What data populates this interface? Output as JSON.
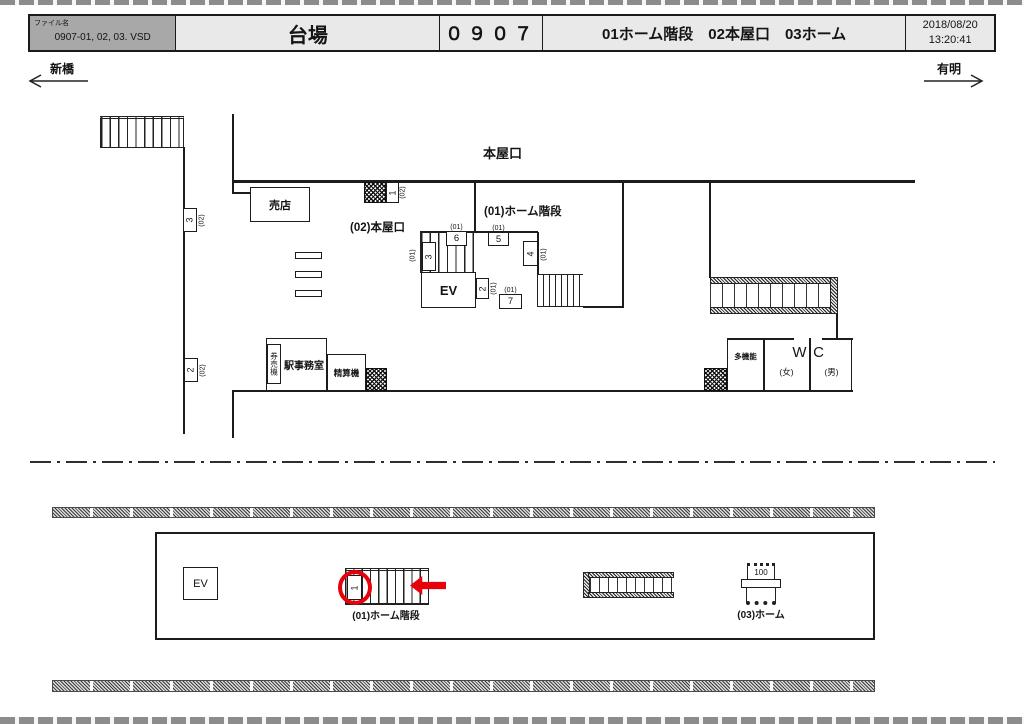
{
  "header": {
    "file_label": "ファイル名",
    "file_name": "0907-01, 02, 03. VSD",
    "station_name": "台場",
    "location_code": "０９０７",
    "location_names": "01ホーム階段　02本屋口　03ホーム",
    "date": "2018/08/20",
    "time": "13:20:41"
  },
  "directions": {
    "left": "新橋",
    "right": "有明"
  },
  "concourse": {
    "entrance_title": "本屋口",
    "area_label_02": "(02)本屋口",
    "area_label_01": "(01)ホーム階段",
    "shop_label": "売店",
    "elevator_label": "EV",
    "office_label": "駅事務室",
    "ticket_machine_label": "券売機",
    "fare_adjust_label": "精算機",
    "toilet": {
      "multi_label": "多機能",
      "women_label": "(女)",
      "wc_w": "W",
      "wc_c": "C",
      "men_label": "(男)"
    }
  },
  "ad_positions": [
    {
      "prefix": "(02)",
      "no": "1"
    },
    {
      "prefix": "(02)",
      "no": "3"
    },
    {
      "prefix": "(02)",
      "no": "2"
    },
    {
      "prefix": "(01)",
      "no": "3"
    },
    {
      "prefix": "(01)",
      "no": "6"
    },
    {
      "prefix": "(01)",
      "no": "5"
    },
    {
      "prefix": "(01)",
      "no": "4"
    },
    {
      "prefix": "(01)",
      "no": "2"
    },
    {
      "prefix": "(01)",
      "no": "7"
    }
  ],
  "platform": {
    "elevator_label": "EV",
    "stairs_label": "(01)ホーム階段",
    "platform_label": "(03)ホーム",
    "highlighted_no": "1",
    "vending_text": "100"
  },
  "colors": {
    "highlight": "#e8000a",
    "line": "#1c1c1c"
  }
}
